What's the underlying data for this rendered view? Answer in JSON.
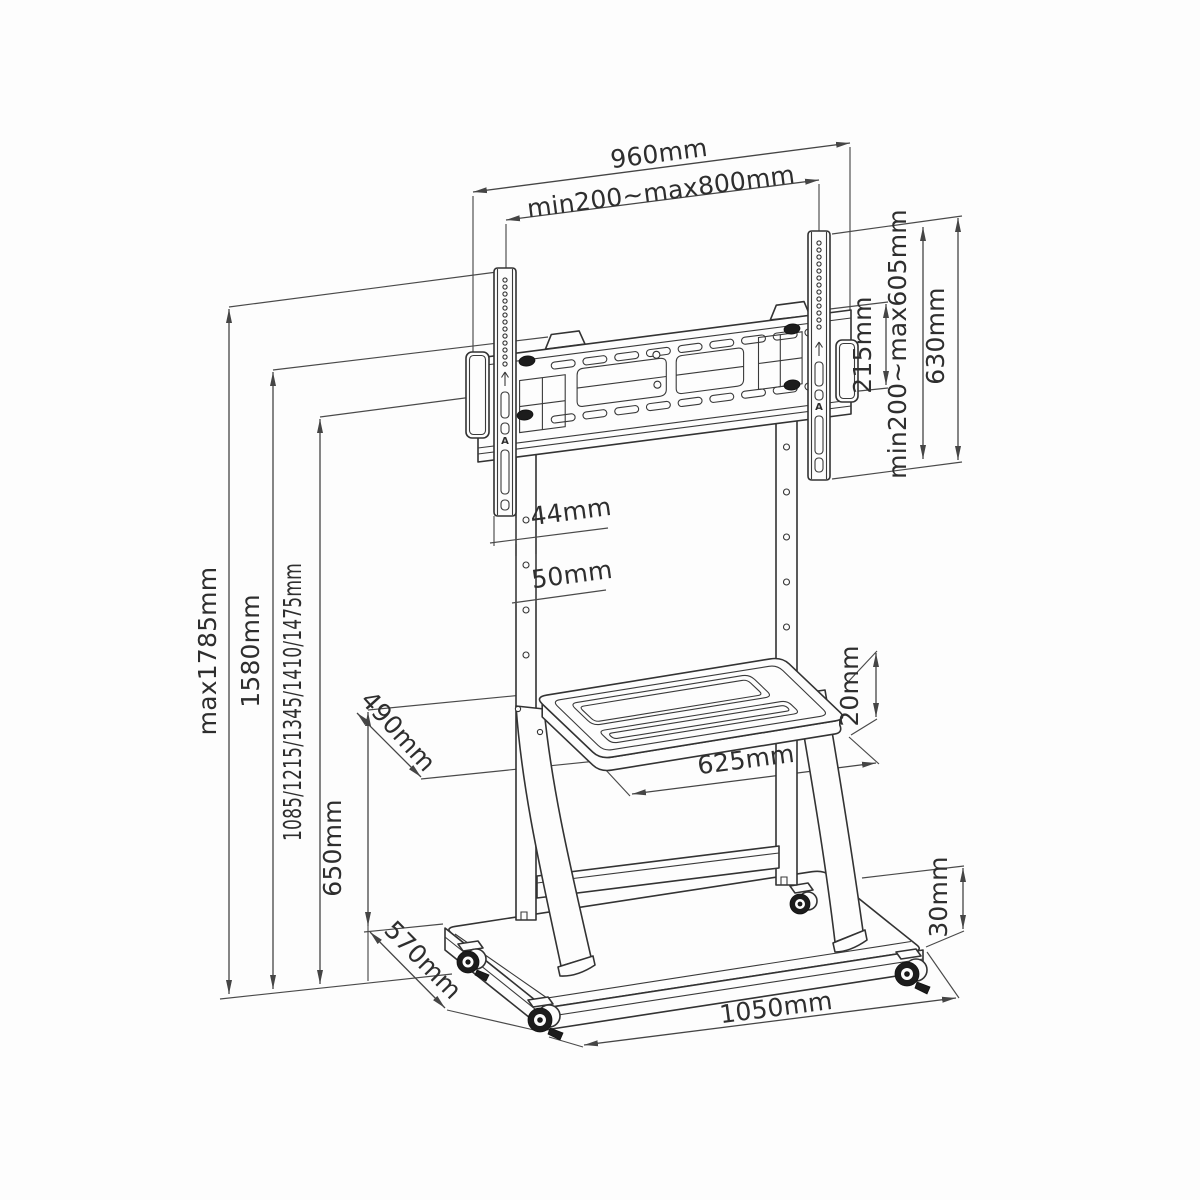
{
  "drawing": {
    "type": "technical dimension drawing",
    "subject": "mobile TV trolley floor stand with VESA bracket, shelf and wheeled base",
    "line_color": "#3a3a3a",
    "background_color": "#fdfdfd"
  },
  "dimensions": {
    "overall_width": "960mm",
    "vesa_width_range": "min200~max800mm",
    "hole_pitch": "215mm",
    "vesa_height_range": "min200~max605mm",
    "bracket_rail_height": "630mm",
    "rail_depth": "44mm",
    "column_width": "50mm",
    "overall_height_max": "max1785mm",
    "bracket_top_height": "1580mm",
    "screen_center_heights": "1085/1215/1345/1410/1475mm",
    "shelf_height_above_base": "650mm",
    "shelf_depth": "490mm",
    "shelf_thickness": "20mm",
    "shelf_width": "625mm",
    "base_depth": "570mm",
    "base_width": "1050mm",
    "base_thickness": "30mm"
  },
  "markings": {
    "rail_logo": "A"
  }
}
